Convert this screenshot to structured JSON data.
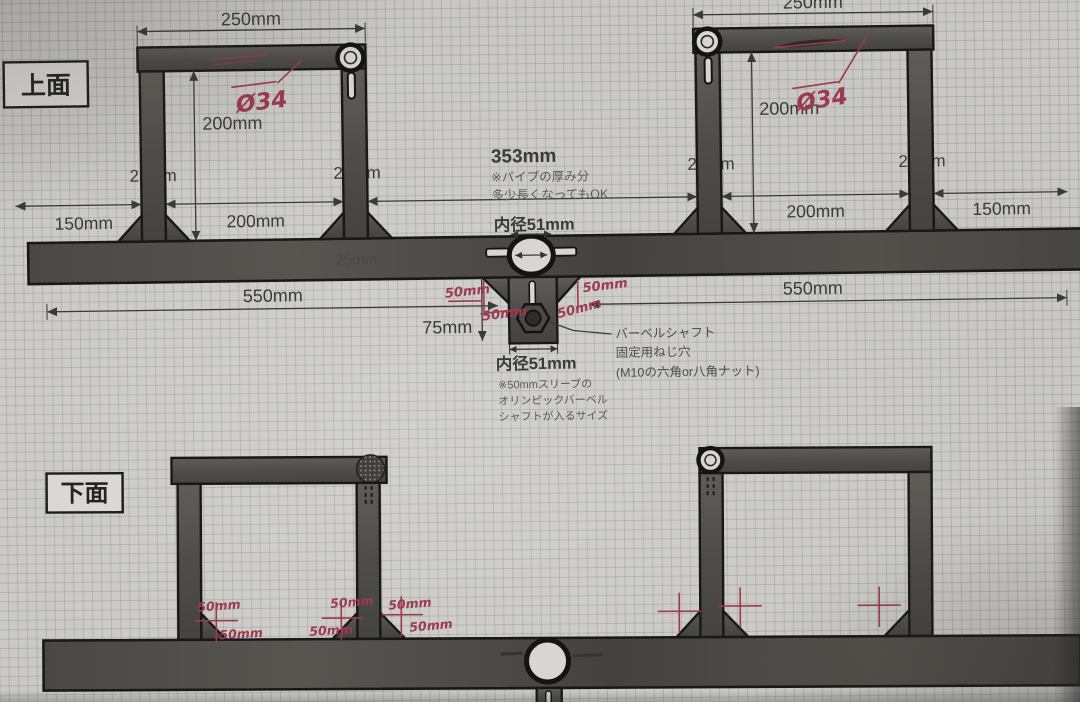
{
  "colors": {
    "paper": "#c9c8c4",
    "grid": "#a9aca8",
    "metal": "#514e4b",
    "outline": "#181818",
    "dim_text": "#3a3a3a",
    "note_text": "#5a5a5a",
    "ink": "#9c3a50",
    "hole_fill": "#d7d6d2"
  },
  "top_view": {
    "label": "上面",
    "dim_250_left": "250mm",
    "dim_250_right": "250mm",
    "dim_200v_left": "200mm",
    "dim_200v_right": "200mm",
    "dim_leg_25": [
      "25mm",
      "25mm",
      "25mm",
      "25mm"
    ],
    "dim_beam_25": "25mm",
    "dim_150_left": "150mm",
    "dim_150_right": "150mm",
    "dim_200_bottom_left": "200mm",
    "dim_200_bottom_right": "200mm",
    "dim_353": "353mm",
    "note_353": [
      "※パイプの厚み分",
      "多少長くなってもOK"
    ],
    "bore_top": "内径51mm",
    "dim_550_left": "550mm",
    "dim_550_right": "550mm",
    "dim_75": "75mm",
    "bore_bottom": "内径51mm",
    "bore_note": [
      "※50mmスリーブの",
      "オリンピックバーベル",
      "シャフトが入るサイズ"
    ],
    "screw_note": [
      "バーベルシャフト",
      "固定用ねじ穴",
      "(M10の六角or八角ナット)"
    ],
    "hw_phi_left": "Ø34",
    "hw_phi_right": "Ø34",
    "hw_50": [
      "50mm",
      "50mm",
      "50mm",
      "50mm"
    ]
  },
  "bottom_view": {
    "label": "下面",
    "hw_50": [
      "50mm",
      "50mm",
      "50mm",
      "50mm",
      "50mm",
      "50mm"
    ]
  }
}
